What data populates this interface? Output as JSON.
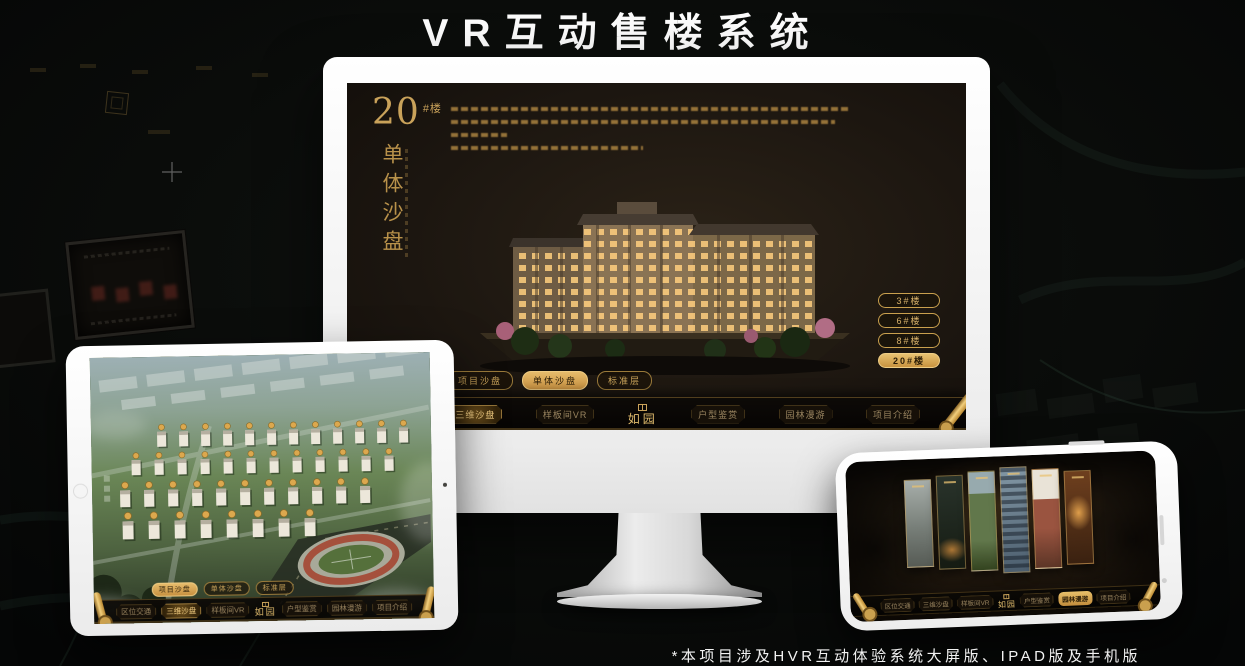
{
  "page": {
    "title": "VR互动售楼系统",
    "footnote": "*本项目涉及HVR互动体验系统大屏版、IPAD版及手机版"
  },
  "brand": {
    "name": "如园"
  },
  "colors": {
    "gold_accent": "#d4af5e",
    "gold_deep": "#8a6a2c",
    "active_fill": "#d8ab55",
    "screen_bg": "#1b1510",
    "device_white": "#f4f4f4"
  },
  "monitor": {
    "heading": {
      "number": "20",
      "unit": "#楼",
      "vertical_title": "单体沙盘"
    },
    "floor_buttons": [
      {
        "label": "3#楼",
        "active": false
      },
      {
        "label": "6#楼",
        "active": false
      },
      {
        "label": "8#楼",
        "active": false
      },
      {
        "label": "20#楼",
        "active": true
      }
    ],
    "view_tabs": [
      {
        "label": "项目沙盘",
        "active": false
      },
      {
        "label": "单体沙盘",
        "active": true
      },
      {
        "label": "标准层",
        "active": false
      }
    ],
    "nav_left": [
      {
        "label": "区位交通",
        "active": false
      },
      {
        "label": "三维沙盘",
        "active": true
      },
      {
        "label": "样板间VR",
        "active": false
      }
    ],
    "nav_right": [
      {
        "label": "户型鉴赏",
        "active": false
      },
      {
        "label": "园林漫游",
        "active": false
      },
      {
        "label": "项目介绍",
        "active": false
      }
    ]
  },
  "tablet": {
    "view_tabs": [
      {
        "label": "项目沙盘",
        "active": true
      },
      {
        "label": "单体沙盘",
        "active": false
      },
      {
        "label": "标准层",
        "active": false
      }
    ],
    "nav_left": [
      {
        "label": "区位交通",
        "active": false
      },
      {
        "label": "三维沙盘",
        "active": true
      },
      {
        "label": "样板间VR",
        "active": false
      }
    ],
    "nav_right": [
      {
        "label": "户型鉴赏",
        "active": false
      },
      {
        "label": "园林漫游",
        "active": false
      },
      {
        "label": "项目介绍",
        "active": false
      }
    ]
  },
  "phone": {
    "nav_left": [
      {
        "label": "区位交通",
        "active": false
      },
      {
        "label": "三维沙盘",
        "active": false
      },
      {
        "label": "样板间VR",
        "active": false
      }
    ],
    "nav_right": [
      {
        "label": "户型鉴赏",
        "active": false
      },
      {
        "label": "园林漫游",
        "active": true
      },
      {
        "label": "项目介绍",
        "active": false
      }
    ]
  }
}
